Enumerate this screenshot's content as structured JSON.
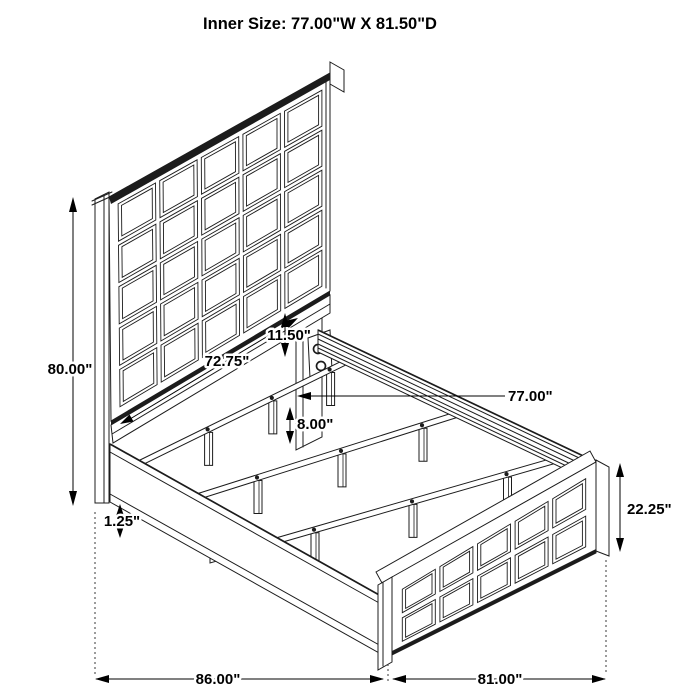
{
  "title": "Inner Size: 77.00\"W X 81.50\"D",
  "dimensions": {
    "overall_height": "80.00\"",
    "headboard_width": "72.75\"",
    "headboard_bottom_gap": "11.50\"",
    "inner_width": "77.00\"",
    "support_leg_height": "8.00\"",
    "rail_lip_height": "1.25\"",
    "footboard_height": "22.25\"",
    "overall_length": "86.00\"",
    "overall_width": "81.00\""
  },
  "colors": {
    "line": "#1c1c1c",
    "text": "#000000",
    "background": "#ffffff"
  }
}
